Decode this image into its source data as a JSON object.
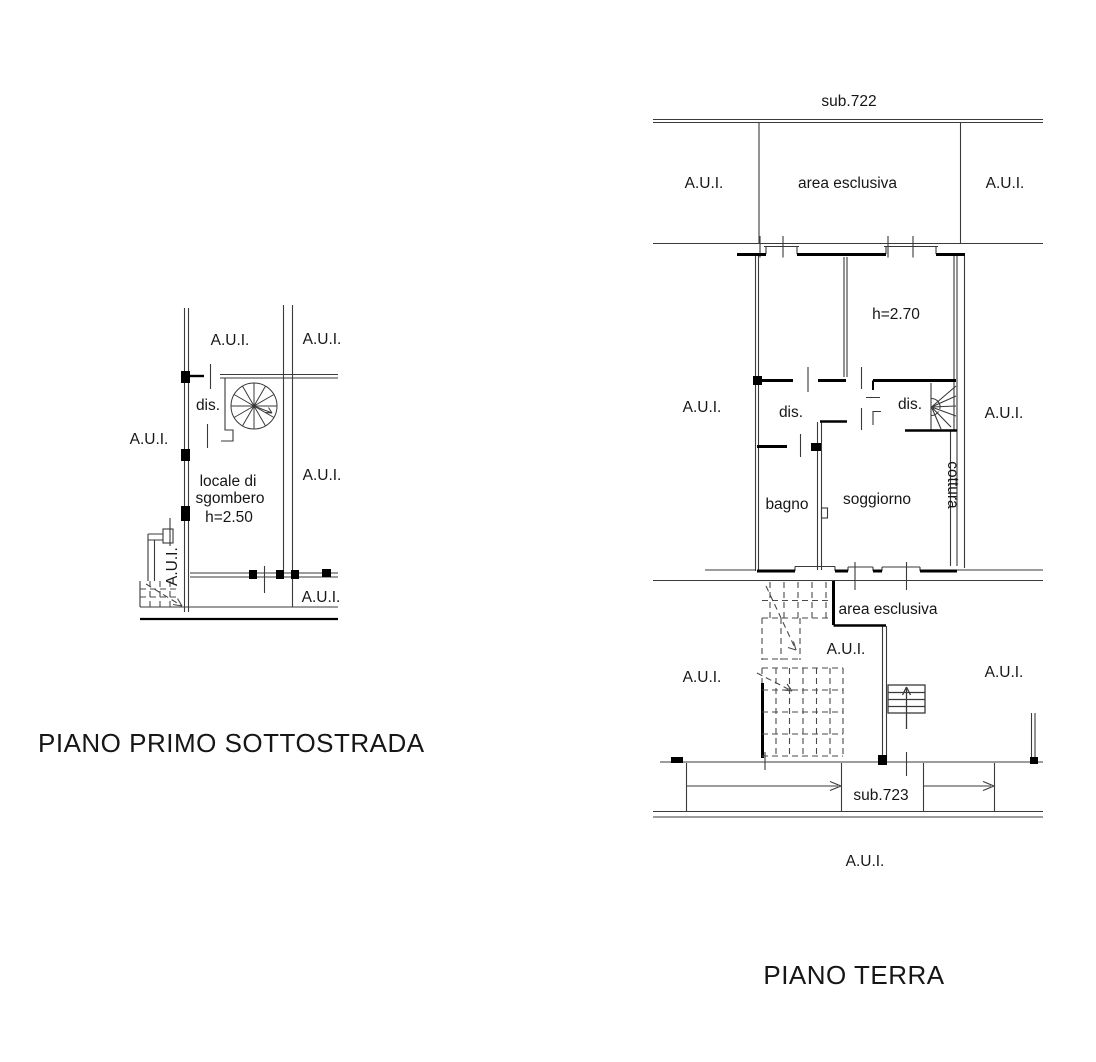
{
  "document": {
    "background": "#ffffff",
    "ink": "#161616",
    "thin_line_color": "#3a3a3a",
    "thick_line_color": "#000000"
  },
  "left_plan": {
    "title": "PIANO PRIMO SOTTOSTRADA",
    "labels": {
      "aui": "A.U.I.",
      "dis": "dis.",
      "room_line1": "locale di",
      "room_line2": "sgombero",
      "room_height": "h=2.50"
    }
  },
  "right_plan": {
    "title": "PIANO TERRA",
    "top_parcel": "sub.722",
    "bottom_parcel": "sub.723",
    "labels": {
      "aui": "A.U.I.",
      "area_esclusiva": "area esclusiva",
      "height": "h=2.70",
      "dis": "dis.",
      "bagno": "bagno",
      "soggiorno": "soggiorno",
      "cottura": "cottura"
    }
  }
}
